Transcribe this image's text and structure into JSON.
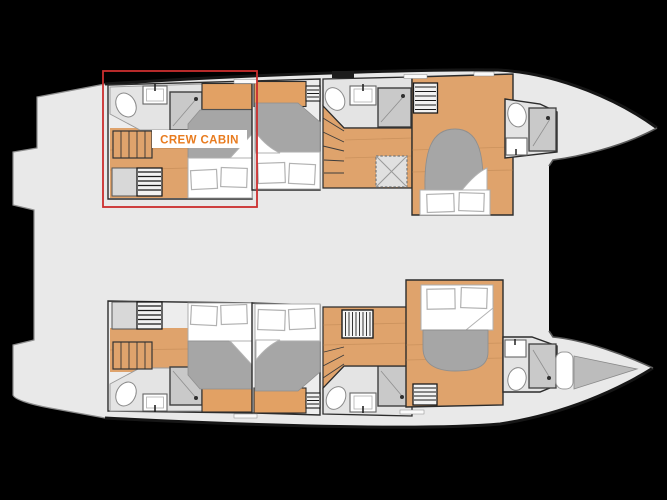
{
  "diagram": {
    "type": "catamaran-deck-plan",
    "highlight_label": "CREW CABIN"
  },
  "colors": {
    "background": "#000000",
    "hull": "#e9e9e9",
    "hull-edge": "#161616",
    "step-edge": "#8c8c8c",
    "room-bg": "#ededed",
    "bath-bg": "#e4e4e4",
    "wood": "#dfa36c",
    "wood-dark": "#b8824e",
    "wardrobe": "#e2a164",
    "duvet": "#a6a6a6",
    "shower": "#c9c9c9",
    "shower-edge": "#3f3f3f",
    "wall": "#2c2c2c",
    "white": "#ffffff",
    "pillow-edge": "#b2b2b2",
    "highlight-red": "#cb2e2e",
    "label-orange": "#e87b1e",
    "forepeak-gray": "#bcbcbc"
  }
}
